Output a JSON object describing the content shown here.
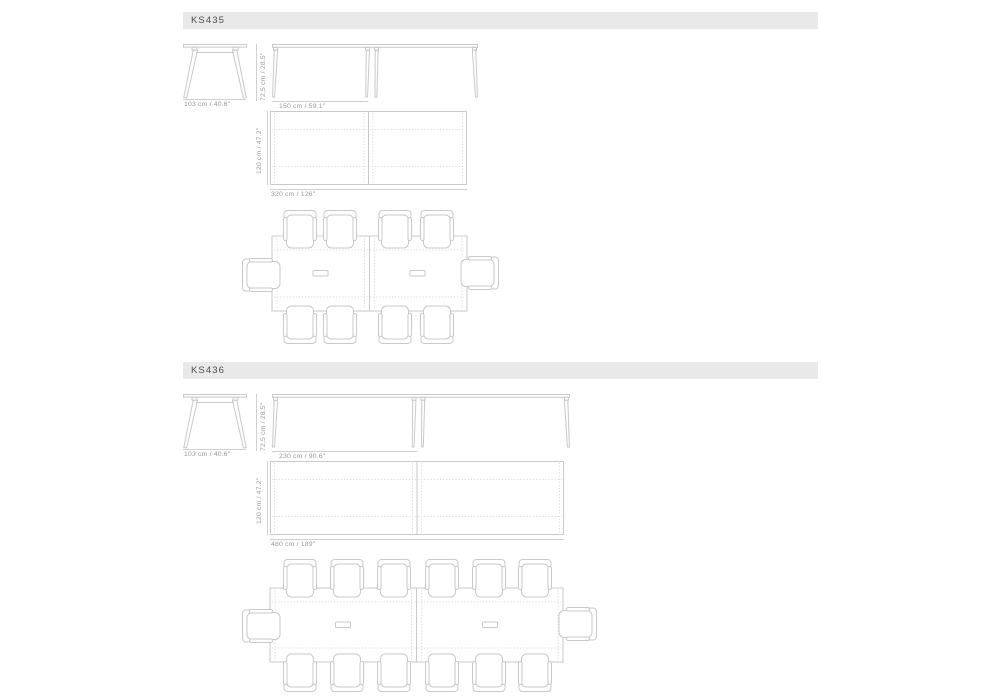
{
  "page": {
    "colors": {
      "background": "#ffffff",
      "header_bar": "#e9e9e9",
      "header_text": "#4c4c4c",
      "drawing_line": "#c9c9c9",
      "dashed_line": "#dadada",
      "dimension_text": "#979797"
    }
  },
  "sections": [
    {
      "code": "KS435",
      "labels": {
        "width": "103 cm / 40.6\"",
        "height": "72,5 cm / 28.5\"",
        "module": "150 cm / 59.1\"",
        "depth": "120 cm / 47.2\"",
        "total": "320 cm / 126\""
      },
      "seats": 10
    },
    {
      "code": "KS436",
      "labels": {
        "width": "103 cm / 40.6\"",
        "height": "72,5 cm / 28.5\"",
        "module": "230 cm / 90.6\"",
        "depth": "120 cm / 47.2\"",
        "total": "480 cm / 189\""
      },
      "seats": 14
    }
  ]
}
